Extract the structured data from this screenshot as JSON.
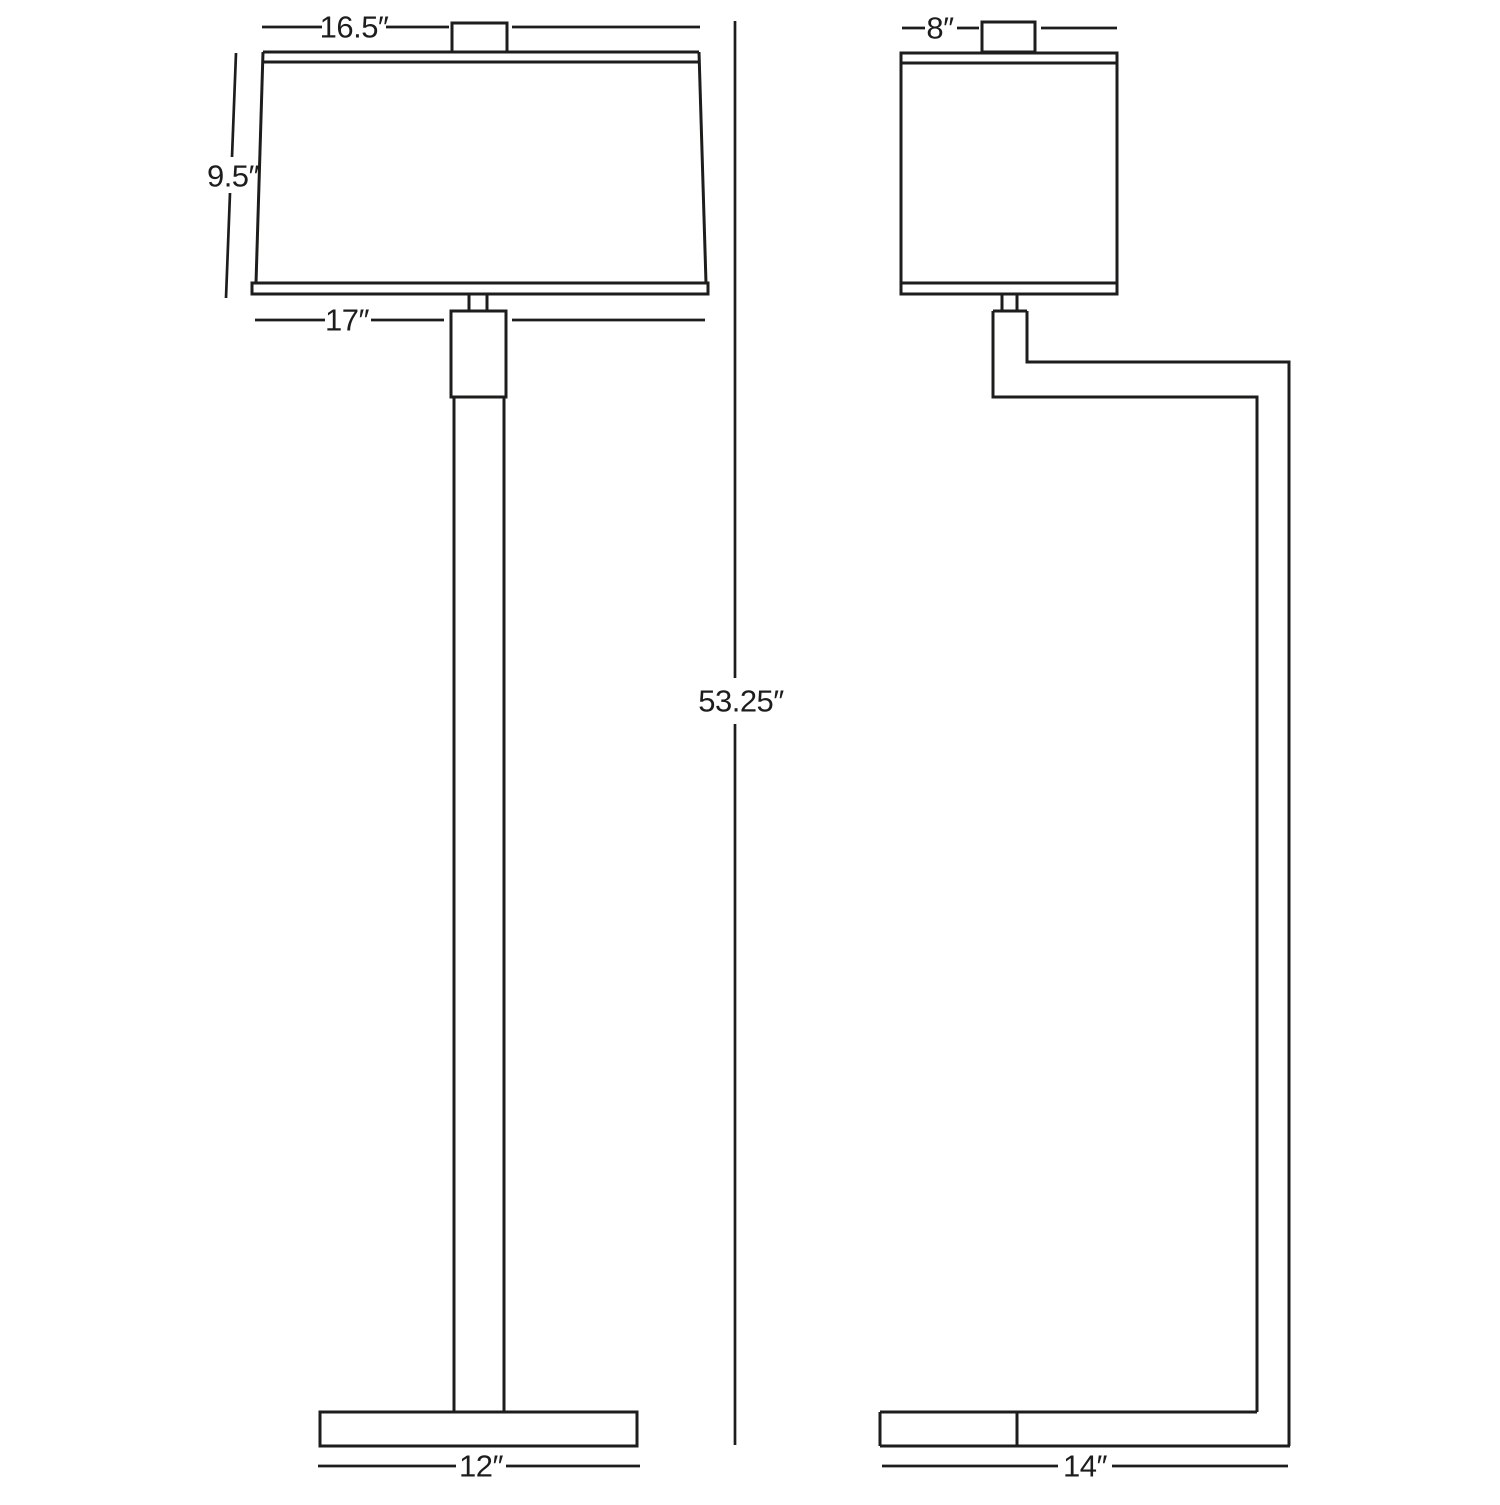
{
  "diagram": {
    "subject": "floor-lamp-dimension-drawing",
    "colors": {
      "line": "#1d1d1b",
      "background": "#ffffff"
    },
    "front_view": {
      "shade_top_width": "16.5″",
      "shade_height": "9.5″",
      "shade_bottom_width": "17″",
      "overall_height": "53.25″",
      "base_width": "12″"
    },
    "side_view": {
      "shade_depth": "8″",
      "base_depth": "14″"
    }
  }
}
